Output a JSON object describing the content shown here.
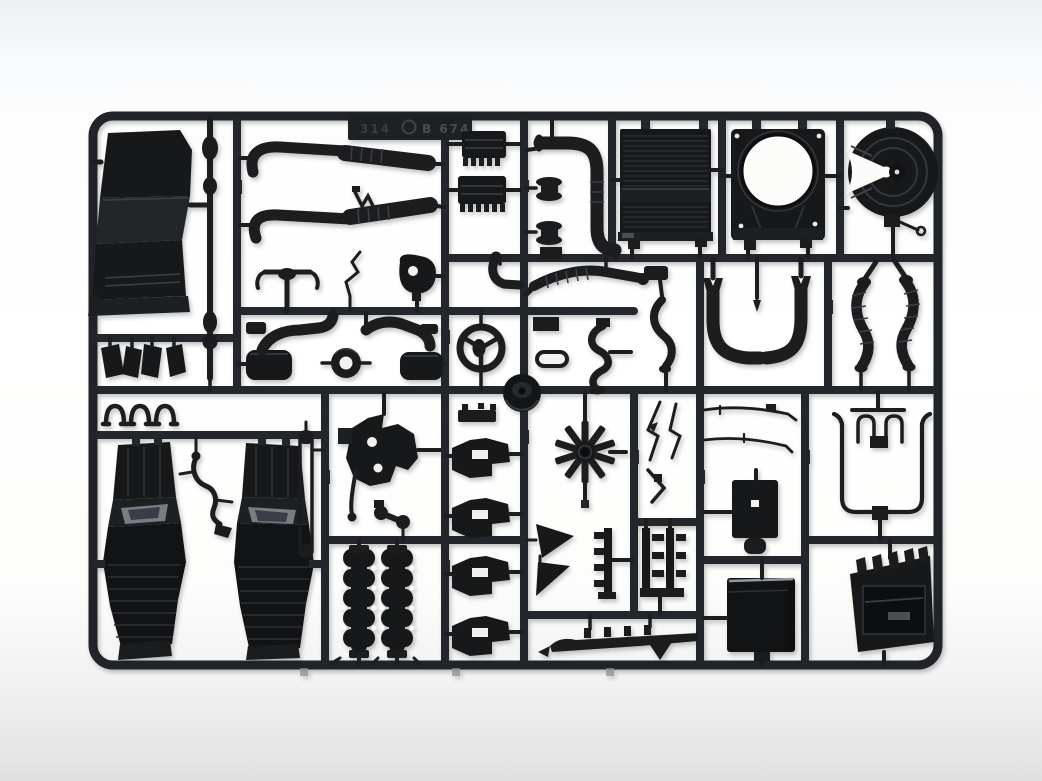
{
  "image": {
    "type": "photograph",
    "subject": "Black injection-moulded plastic model kit sprue (parts tree) for a truck model kit",
    "background": "white studio backdrop with soft grey bands at top and bottom",
    "orientation": "landscape rectangular sprue frame with internal runners forming a grid of part cells"
  },
  "sprue": {
    "tag": {
      "left_text": "314",
      "logo": "circular-maker-logo",
      "right_text": "B 674"
    },
    "colors": {
      "plastic": "#1a1c1e",
      "plastic_deep": "#121315",
      "plastic_highlight": "#3b3f44",
      "metal_glint": "#969aa0",
      "flywheel_glint": "#787d84",
      "backdrop_top": "#edf0f4",
      "backdrop_mid": "#ffffff",
      "backdrop_bottom": "#e0dfdf"
    }
  },
  "parts": [
    {
      "id": "cab-floor-console",
      "label": "Cab floor / engine tunnel console"
    },
    {
      "id": "drive-shaft",
      "label": "Drive shaft with universal joints"
    },
    {
      "id": "exhaust-pipe-upper",
      "label": "Upper exhaust pipe with flex section"
    },
    {
      "id": "exhaust-pipe-lower",
      "label": "Lower exhaust pipe with flex section"
    },
    {
      "id": "shift-linkage",
      "label": "Gear shift linkage"
    },
    {
      "id": "tow-bracket",
      "label": "T-shaped linkage bracket"
    },
    {
      "id": "water-pump",
      "label": "Water pump with mounting hole"
    },
    {
      "id": "air-filter-upper",
      "label": "Finned air filter housing (upper)"
    },
    {
      "id": "air-filter-lower",
      "label": "Finned air filter housing (lower)"
    },
    {
      "id": "belt-pulleys",
      "label": "Belt pulley spools (pair)"
    },
    {
      "id": "intake-elbow-pipe",
      "label": "Large S-curved intake pipe"
    },
    {
      "id": "radiator",
      "label": "Ribbed radiator core"
    },
    {
      "id": "fan-shroud",
      "label": "Fan shroud panel with round opening"
    },
    {
      "id": "fifth-wheel-coupling",
      "label": "Fifth-wheel coupling plate with jaw slot and pull handle"
    },
    {
      "id": "visor-wedges",
      "label": "Four small wedge brackets"
    },
    {
      "id": "spring-clips",
      "label": "U-shaped spring clips"
    },
    {
      "id": "muffler-left",
      "label": "Muffler canister with elbow pipe (left)"
    },
    {
      "id": "muffler-right",
      "label": "Muffler canister with elbow pipe (right)"
    },
    {
      "id": "sealing-ring",
      "label": "Sealing ring / grommet"
    },
    {
      "id": "steering-wheel",
      "label": "Steering wheel"
    },
    {
      "id": "air-cleaner-cover",
      "label": "Conical air cleaner cover disc"
    },
    {
      "id": "flex-exhaust-section",
      "label": "Long flexible exhaust section"
    },
    {
      "id": "mudguard-bracket",
      "label": "S-curved mudguard bracket"
    },
    {
      "id": "corrugated-hose-small",
      "label": "Small wavy hose"
    },
    {
      "id": "intake-u-pipes",
      "label": "Pair of J-pipes forming a U intake duct"
    },
    {
      "id": "corrugated-hoses-pair",
      "label": "Pair of corrugated flexible hoses"
    },
    {
      "id": "engine-block-left-half",
      "label": "Engine block half (left) with flywheel glint"
    },
    {
      "id": "engine-block-right-half",
      "label": "Engine block half (right) with flywheel glint"
    },
    {
      "id": "pipe-bracket",
      "label": "Bent wire bracket between engine halves"
    },
    {
      "id": "chassis-rod",
      "label": "Long thin chassis rod"
    },
    {
      "id": "gearbox",
      "label": "Gearbox casting with bolt holes and lever"
    },
    {
      "id": "ball-linkage",
      "label": "Double ball linkage"
    },
    {
      "id": "exhaust-manifolds",
      "label": "Two lobed exhaust manifolds"
    },
    {
      "id": "engine-mount-brackets",
      "label": "Four stepped engine mount brackets"
    },
    {
      "id": "cooling-fan",
      "label": "Ten-blade cooling fan"
    },
    {
      "id": "bracket-blades",
      "label": "Angular bracket blades"
    },
    {
      "id": "leaf-spring-combs",
      "label": "Toothed leaf-spring hangers"
    },
    {
      "id": "chassis-member-bar",
      "label": "Long notched chassis member"
    },
    {
      "id": "relay-box",
      "label": "Relay box with mounting hole"
    },
    {
      "id": "thin-control-rods",
      "label": "Thin control rods"
    },
    {
      "id": "wiper-levers",
      "label": "Thin wiper-style levers"
    },
    {
      "id": "air-line-tubing",
      "label": "Bent air-line tubing set"
    },
    {
      "id": "battery-box",
      "label": "Battery box with lid glint"
    },
    {
      "id": "cab-step-panel",
      "label": "Slotted cab step / louvre panel"
    }
  ]
}
